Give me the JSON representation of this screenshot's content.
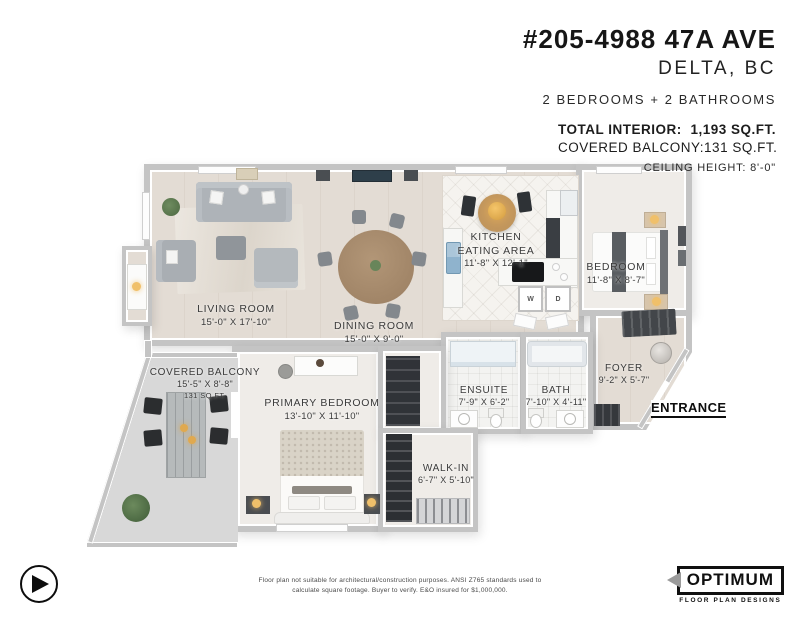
{
  "header": {
    "address": "#205-4988 47A AVE",
    "city": "DELTA, BC",
    "summary": "2 BEDROOMS + 2 BATHROOMS",
    "total_interior_label": "TOTAL INTERIOR:",
    "total_interior_value": "1,193 SQ.FT.",
    "balcony_label": "COVERED BALCONY:",
    "balcony_value": "131 SQ.FT.",
    "ceiling": "CEILING HEIGHT: 8'-0\""
  },
  "rooms": {
    "living": {
      "name": "LIVING ROOM",
      "dims": "15'-0\" X 17'-10\""
    },
    "dining": {
      "name": "DINING ROOM",
      "dims": "15'-0\" X 9'-0\""
    },
    "kitchen": {
      "name_line1": "KITCHEN",
      "name_line2": "EATING AREA",
      "dims": "11'-8\" X 12'-1\""
    },
    "bedroom": {
      "name": "BEDROOM",
      "dims": "11'-8\" X 8'-7\""
    },
    "balcony": {
      "name": "COVERED BALCONY",
      "dims": "15'-5\" X 8'-8\"",
      "area": "131 SQ.FT."
    },
    "primary": {
      "name": "PRIMARY BEDROOM",
      "dims": "13'-10\" X 11'-10\""
    },
    "ensuite": {
      "name": "ENSUITE",
      "dims": "7'-9\" X 6'-2\""
    },
    "bath": {
      "name": "BATH",
      "dims": "7'-10\" X 4'-11\""
    },
    "foyer": {
      "name": "FOYER",
      "dims": "9'-2\" X 5'-7\""
    },
    "walkin": {
      "name": "WALK-IN",
      "dims": "6'-7\" X 5'-10\""
    }
  },
  "plan": {
    "entrance_label": "ENTRANCE",
    "washer_label": "W",
    "dryer_label": "D"
  },
  "footer": {
    "disclaimer_line1": "Floor plan not suitable for architectural/construction purposes. ANSI Z765 standards used to",
    "disclaimer_line2": "calculate square footage. Buyer to verify.  E&O insured for $1,000,000."
  },
  "branding": {
    "logo_name": "OPTIMUM",
    "logo_tagline": "FLOOR PLAN DESIGNS"
  },
  "colors": {
    "wall": "#c4c4c4",
    "wood_floor": "#e3dcd4",
    "carpet": "#efece8",
    "accent_gold": "#d29b3f",
    "label_text": "#3b3b3b"
  }
}
